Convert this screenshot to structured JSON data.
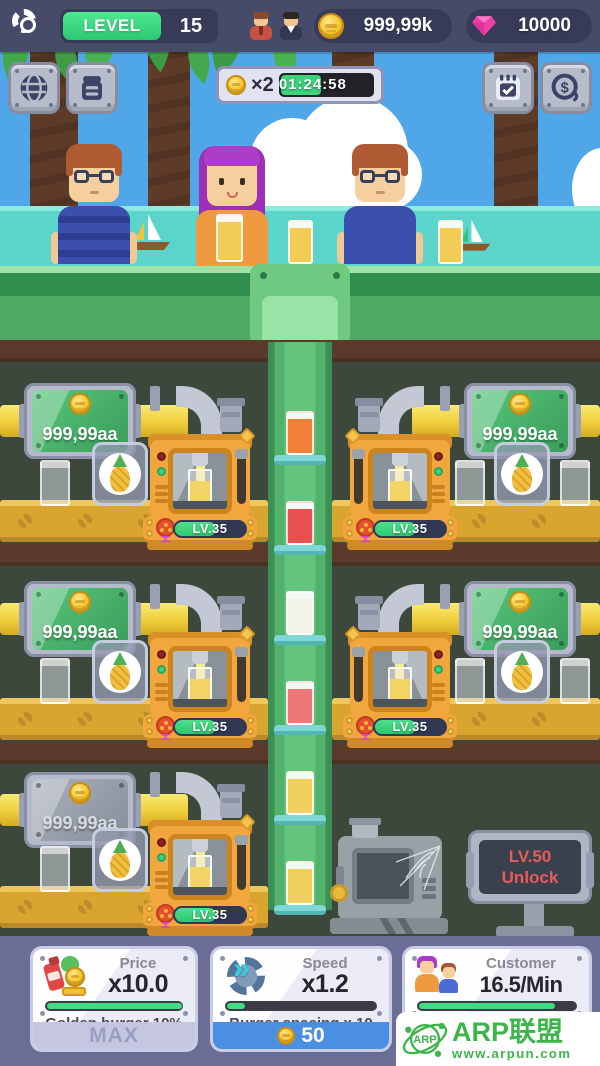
{
  "hud": {
    "level_label": "LEVEL",
    "level_value": "15",
    "coins": "999,99k",
    "gems": "10000"
  },
  "boost": {
    "multiplier": "×2",
    "timer": "01:24:58"
  },
  "factory": {
    "income_sign": "999,99aa",
    "machine_level": "LV.35",
    "locked_line1": "LV.50",
    "locked_line2": "Unlock"
  },
  "upgrades": {
    "price": {
      "title": "Price",
      "value": "x10.0",
      "subtitle": "Golden burger 10%",
      "button": "MAX",
      "progress": 100
    },
    "speed": {
      "title": "Speed",
      "value": "x1.2",
      "subtitle": "Burger spacing x 10",
      "button": "50",
      "progress": 12
    },
    "customer": {
      "title": "Customer",
      "value": "16.5/Min",
      "subtitle": "Max customer 3",
      "progress": 85
    }
  },
  "watermark": {
    "badge": "ARP",
    "title": "ARP联盟",
    "url": "www.arpun.com"
  }
}
